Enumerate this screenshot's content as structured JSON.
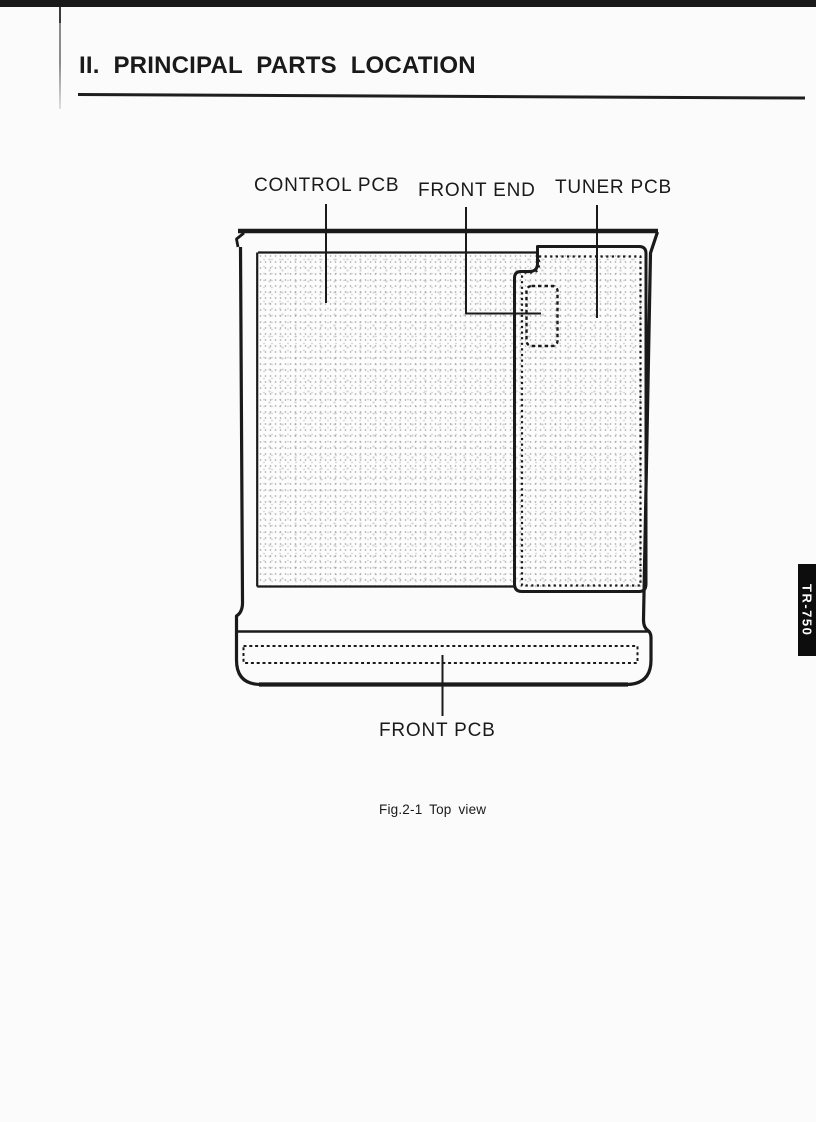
{
  "theme": {
    "ink": "#1a1a1a",
    "paper": "#fbfbfb",
    "tab-bg": "#0d0d0d",
    "tab-text": "#ffffff"
  },
  "header": {
    "title": "II. PRINCIPAL PARTS LOCATION"
  },
  "figure": {
    "caption": "Fig.2-1 Top view",
    "labels": {
      "control_pcb": "CONTROL PCB",
      "front_end": "FRONT END",
      "tuner_pcb": "TUNER PCB",
      "front_pcb": "FRONT PCB"
    }
  },
  "side_tab": {
    "label": "TR-750"
  }
}
